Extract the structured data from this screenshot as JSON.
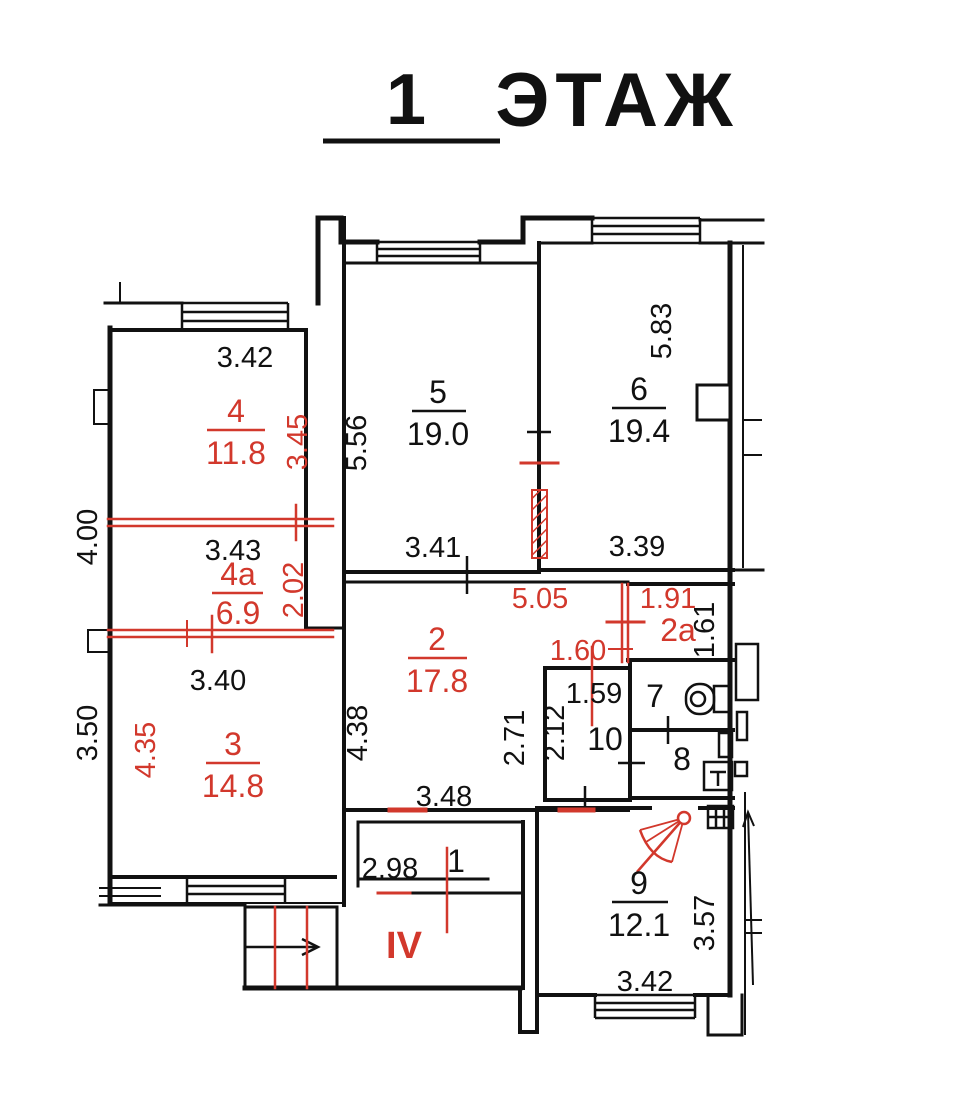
{
  "title": {
    "floor_number": "1",
    "floor_word": "ЭТАЖ"
  },
  "colors": {
    "wall": "#111111",
    "annotation": "#d2382c",
    "background": "#ffffff"
  },
  "rooms": {
    "r1": {
      "number": "1"
    },
    "r2": {
      "number": "2",
      "area": "17.8"
    },
    "r2a": {
      "number": "2a"
    },
    "r3": {
      "number": "3",
      "area": "14.8"
    },
    "r4": {
      "number": "4",
      "area": "11.8"
    },
    "r4a": {
      "number": "4a",
      "area": "6.9"
    },
    "r5": {
      "number": "5",
      "area": "19.0"
    },
    "r6": {
      "number": "6",
      "area": "19.4"
    },
    "r7": {
      "number": "7"
    },
    "r8": {
      "number": "8"
    },
    "r9": {
      "number": "9",
      "area": "12.1"
    },
    "r10": {
      "number": "10"
    },
    "corridor": {
      "number": "IV"
    }
  },
  "dimensions_black": {
    "room4_top": "3.42",
    "room4a_top": "3.43",
    "room3_top": "3.40",
    "room5_left": "5.56",
    "room5_bottom": "3.41",
    "room6_left": "5.83",
    "room6_bottom": "3.39",
    "room2_left": "4.38",
    "room2_right": "2.71",
    "room2_bottom": "3.48",
    "room10_top": "1.59",
    "room10_left": "2.12",
    "room2a_right": "1.61",
    "room1_width": "2.98",
    "room9_right": "3.57",
    "room9_bottom": "3.42",
    "left_upper": "4.00",
    "left_lower": "3.50"
  },
  "dimensions_red": {
    "room4_right": "3.45",
    "room4a_right": "2.02",
    "room2_top": "5.05",
    "room2a_top": "1.91",
    "room10_opening": "1.60",
    "room3_left": "4.35"
  }
}
